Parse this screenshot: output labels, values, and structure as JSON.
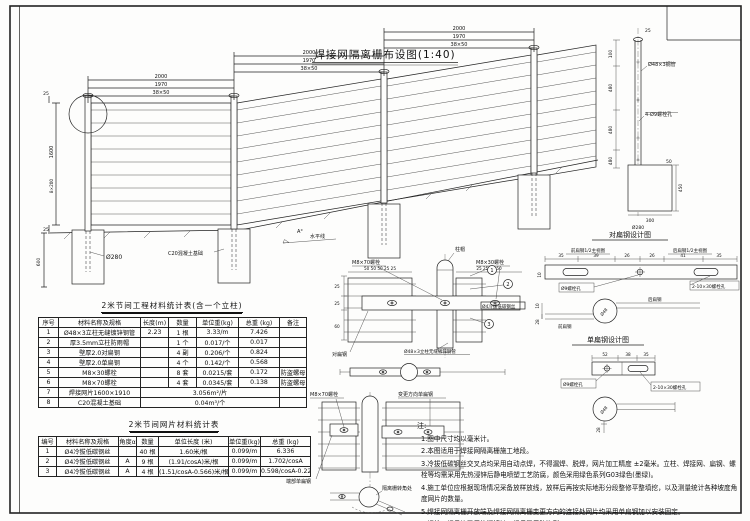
{
  "drawing": {
    "title": "焊接网隔离栅布设图(1:40)",
    "elev": {
      "d2000": "2000",
      "d1970": "1970",
      "dwire": "38×50",
      "h1600": "1600",
      "hsub": "8×200",
      "d25": "25",
      "d600": "600",
      "dia280": "Ø280",
      "conc": "C20混凝土基础",
      "angle": "A°",
      "horizon": "水平线"
    },
    "post": {
      "pipe": "Ø48×3钢管",
      "holes": "4-Ø9螺栓孔",
      "d25": "25",
      "d100": "100",
      "d480": "480",
      "d50": "50",
      "d450": "450",
      "d300": "300",
      "dia": "Ø280"
    },
    "pair": {
      "title": "对扁钢设计图",
      "front_view": "前扁钢1/2主视图",
      "back_view": "后扁钢1/2主视图",
      "dims": [
        "35",
        "39",
        "26",
        "26",
        "41",
        "35"
      ],
      "d10": "10",
      "d28": "28",
      "hole": "Ø9螺栓孔",
      "slot": "2-10×30螺栓孔",
      "back": "后扁钢",
      "front": "前扁钢",
      "dia": "Ø48"
    },
    "single": {
      "title": "单扁钢设计图",
      "d52": "52",
      "d38": "38",
      "d35": "35",
      "hole": "Ø9螺栓孔",
      "slot": "2-10×30螺栓孔",
      "d28": "28",
      "dia": "Ø48"
    },
    "joint": {
      "cap": "柱帽",
      "bolt70": "M8×70螺栓",
      "bolt30": "M8×30螺栓",
      "wire": "Ø4冷拔低碳钢丝",
      "pair_flat": "对扁钢",
      "post_label": "Ø48×3立柱无缝镀锌钢管",
      "n1": "1",
      "n2": "2",
      "n3": "3",
      "dims_l": "50 50 50 25 25",
      "dims_r": "25 25 50 50",
      "d25": "25",
      "d60": "60"
    },
    "corner": {
      "bolt70": "M8×70螺栓",
      "turn": "变更方向单扁钢",
      "end": "端部单扁钢",
      "corner": "隔离栅转角处"
    }
  },
  "table1": {
    "title": "2米节间工程材料统计表(含一个立柱)",
    "headers": [
      "序号",
      "材料名称及规格",
      "长度(m)",
      "数量",
      "单位重(kg)",
      "总重 (kg)",
      "备注"
    ],
    "rows": [
      [
        "1",
        "Ø48×3立柱无缝镀锌钢管",
        "2.23",
        "1 根",
        "3.33/m",
        "7.426",
        ""
      ],
      [
        "2",
        "厚3.5mm立柱防雨帽",
        "",
        "1 个",
        "0.017/个",
        "0.017",
        ""
      ],
      [
        "3",
        "壁厚2.0对扁钢",
        "",
        "4 副",
        "0.206/个",
        "0.824",
        ""
      ],
      [
        "4",
        "壁厚2.0单扁钢",
        "",
        "4 个",
        "0.142/个",
        "0.568",
        ""
      ],
      [
        "5",
        "M8×30螺栓",
        "",
        "8 套",
        "0.0215/套",
        "0.172",
        "防盗螺母"
      ],
      [
        "6",
        "M8×70螺栓",
        "",
        "4 套",
        "0.0345/套",
        "0.138",
        "防盗螺母"
      ]
    ],
    "row7": {
      "no": "7",
      "name": "焊接网片1600×1910",
      "merged": "3.056m²/片",
      "note": ""
    },
    "row8": {
      "no": "8",
      "name": "C20混凝土基础",
      "merged": "0.04m³/个",
      "note": ""
    }
  },
  "table2": {
    "title": "2米节间网片材料统计表",
    "headers": [
      "编号",
      "材料名称及规格",
      "角度α",
      "数量",
      "单位长度 (米)",
      "单位重(kg)",
      "总重 (kg)"
    ],
    "rows": [
      [
        "1",
        "Ø4冷拔低碳钢丝",
        "",
        "40 根",
        "1.60米/根",
        "0.099/m",
        "6.336"
      ],
      [
        "2",
        "Ø4冷拔低碳钢丝",
        "A",
        "9 根",
        "(1.91/cosA)米/根",
        "0.099/m",
        "1.702/cosA"
      ],
      [
        "3",
        "Ø4冷拔低碳钢丝",
        "A",
        "4 根",
        "(1.51/cosA-0.566)米/根",
        "0.099/m",
        "0.598/cosA-0.224"
      ]
    ]
  },
  "notes": {
    "title": "注:",
    "items": [
      "1.图中尺寸均以毫米计。",
      "2.本图适用于焊接网隔离栅施工地段。",
      "3.冷拔低碳钢丝交叉点均采用自动点焊，不得漏焊、脱焊，网片加工精度 ±2毫米。立柱、焊接网、扁钢、螺栓等均需采用先热浸锌后静电喷塑工艺防腐，颜色采用绿色系列G03绿色(墨绿)。",
      "4.施工单位应根据现场情况采备放样放线，放样后再按实际地形分段整修平整填挖，以及测量统计各种坡度角度网片的数量。",
      "5.焊接网隔离栅开放端及焊接网隔离栅变更方向的连接处网片均采用单扁钢加以安装固定。",
      "6.螺栓、螺母均采用热浸镀锌，螺母采用防盗型。"
    ]
  }
}
